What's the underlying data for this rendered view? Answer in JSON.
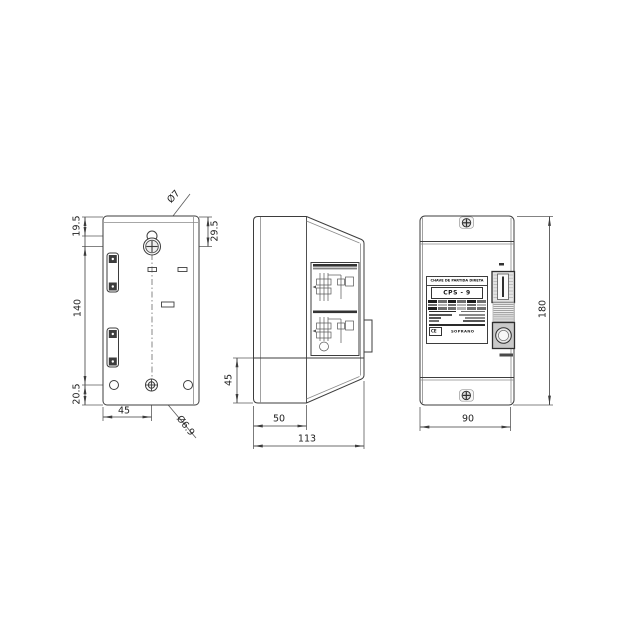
{
  "drawing": {
    "back_view": {
      "dim_19_5": "19.5",
      "dim_140": "140",
      "dim_20_5": "20.5",
      "dim_29_5": "29.5",
      "dim_45": "45",
      "top_hole_dia": "Ø7",
      "bottom_hole_dia": "Ø6.9"
    },
    "side_view": {
      "dim_45": "45",
      "dim_50": "50",
      "dim_113": "113"
    },
    "front_view": {
      "dim_180": "180",
      "dim_90": "90",
      "nameplate": {
        "title": "CHAVE DE PARTIDA DIRETA",
        "model": "CPS - 9",
        "ce_mark": "CE",
        "brand": "SOPRANO"
      }
    }
  }
}
